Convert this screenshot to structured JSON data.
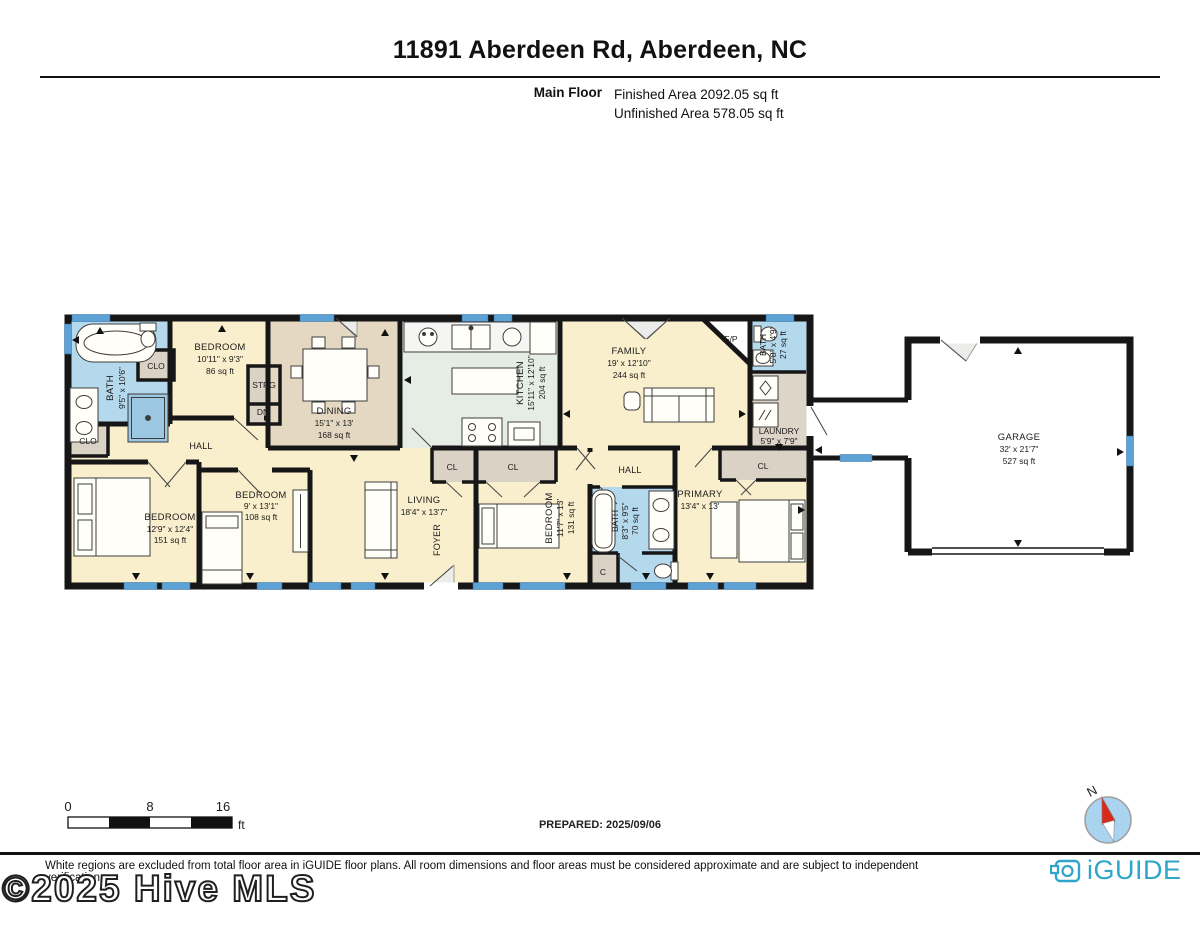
{
  "header": {
    "title": "11891 Aberdeen Rd, Aberdeen, NC",
    "floor_label": "Main Floor",
    "finished_area": "Finished Area 2092.05 sq ft",
    "unfinished_area": "Unfinished Area 578.05 sq ft"
  },
  "rooms": {
    "bath_main": {
      "name": "BATH",
      "dims": "9'5\" x 10'6\""
    },
    "clo_bath": {
      "name": "CLO"
    },
    "bedroom_top": {
      "name": "BEDROOM",
      "dims": "10'11\" x 9'3\"",
      "area": "86 sq ft"
    },
    "strg": {
      "name": "STRG"
    },
    "dn": {
      "name": "DN"
    },
    "dining": {
      "name": "DINING",
      "dims": "15'1\" x 13'",
      "area": "168 sq ft"
    },
    "kitchen": {
      "name": "KITCHEN",
      "dims": "15'11\" x 12'10\"",
      "area": "204 sq ft"
    },
    "family": {
      "name": "FAMILY",
      "dims": "19' x 12'10\"",
      "area": "244 sq ft"
    },
    "fp": {
      "name": "F/P"
    },
    "bath_small": {
      "name": "BATH",
      "dims": "5'8\" x 4'9\"",
      "area": "27 sq ft"
    },
    "laundry": {
      "name": "LAUNDRY",
      "dims": "5'9\" x 7'9\""
    },
    "garage": {
      "name": "GARAGE",
      "dims": "32' x 21'7\"",
      "area": "527 sq ft"
    },
    "clo_left": {
      "name": "CLO"
    },
    "hall_left": {
      "name": "HALL"
    },
    "bedroom_left": {
      "name": "BEDROOM",
      "dims": "12'9\" x 12'4\"",
      "area": "151 sq ft"
    },
    "bedroom_mid": {
      "name": "BEDROOM",
      "dims": "9' x 13'1\"",
      "area": "108 sq ft"
    },
    "living": {
      "name": "LIVING",
      "dims": "18'4\" x 13'7\""
    },
    "foyer": {
      "name": "FOYER"
    },
    "cl_living": {
      "name": "CL"
    },
    "cl_bedroom": {
      "name": "CL"
    },
    "bedroom_right": {
      "name": "BEDROOM",
      "dims": "11'7\" x 13'",
      "area": "131 sq ft"
    },
    "hall_mid": {
      "name": "HALL"
    },
    "bath_right": {
      "name": "BATH",
      "dims": "8'3\" x 9'5\"",
      "area": "70 sq ft"
    },
    "c_closet": {
      "name": "C"
    },
    "primary": {
      "name": "PRIMARY",
      "dims": "13'4\" x 13'"
    },
    "cl_primary": {
      "name": "CL"
    }
  },
  "scale_bar": {
    "tick0": "0",
    "tick1": "8",
    "tick2": "16",
    "unit": "ft"
  },
  "prepared": "PREPARED: 2025/09/06",
  "compass": {
    "north_label": "N"
  },
  "footer": {
    "disclaimer": "White regions are excluded from total floor area in iGUIDE floor plans. All room dimensions and floor areas must be considered approximate and are subject to independent verification.",
    "brand": "iGUIDE",
    "watermark": "©2025 Hive MLS"
  },
  "colors": {
    "floor_cream": "#FAEFCD",
    "floor_tan": "#E4D8C2",
    "floor_kitchen": "#E6EDE5",
    "floor_bath": "#B5D9EC",
    "floor_closet": "#DAD2C4",
    "floor_laundry": "#DDD5C7",
    "wall": "#161616",
    "window": "#5EA1D4",
    "brand": "#2FA6C9",
    "compass_red": "#D42B1E"
  }
}
